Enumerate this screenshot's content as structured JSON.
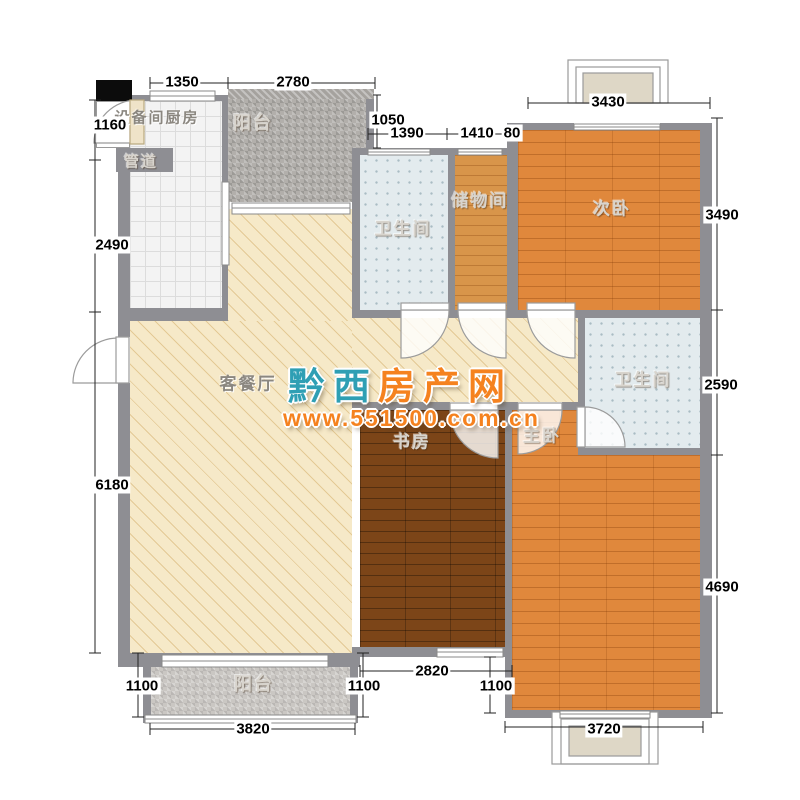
{
  "rooms": {
    "kitchen": "设备间厨房",
    "duct": "管道",
    "balcony_top": "阳台",
    "bathroom_mid": "卫生间",
    "storage": "储物间",
    "bedroom_secondary": "次卧",
    "living_dining": "客餐厅",
    "bathroom_master": "卫生间",
    "study": "书房",
    "bedroom_master": "主卧",
    "balcony_bottom": "阳台"
  },
  "dimensions": {
    "top_kitchen_width": "1350",
    "top_balcony_width": "2780",
    "top_bedroom_width": "3430",
    "offset_balcony_bath": "1050",
    "bath_mid_width": "1390",
    "storage_width": "1410",
    "wall_gap": "80",
    "left_top": "1160",
    "left_kitchen": "2490",
    "left_living": "6180",
    "right_bedroom2": "3490",
    "right_bath": "2590",
    "right_master": "4690",
    "bottom_balcony_height": "1100",
    "bottom_balcony_width": "3820",
    "bottom_mid_height": "1100",
    "study_width": "2820",
    "bottom_right_height": "1100",
    "master_width": "3720"
  },
  "watermark": {
    "chars": [
      "黔",
      "西",
      "房",
      "产",
      "网"
    ],
    "url": "www.551500.com.cn",
    "color_teal": "#2f9fb4",
    "color_orange": "#f5821f"
  },
  "colors": {
    "wall": "#8e8e93",
    "wood": "#e0883c",
    "wood_dark": "#7c4518",
    "tile_bath": "#e3ebee",
    "living_beige": "#f6e9c8"
  }
}
